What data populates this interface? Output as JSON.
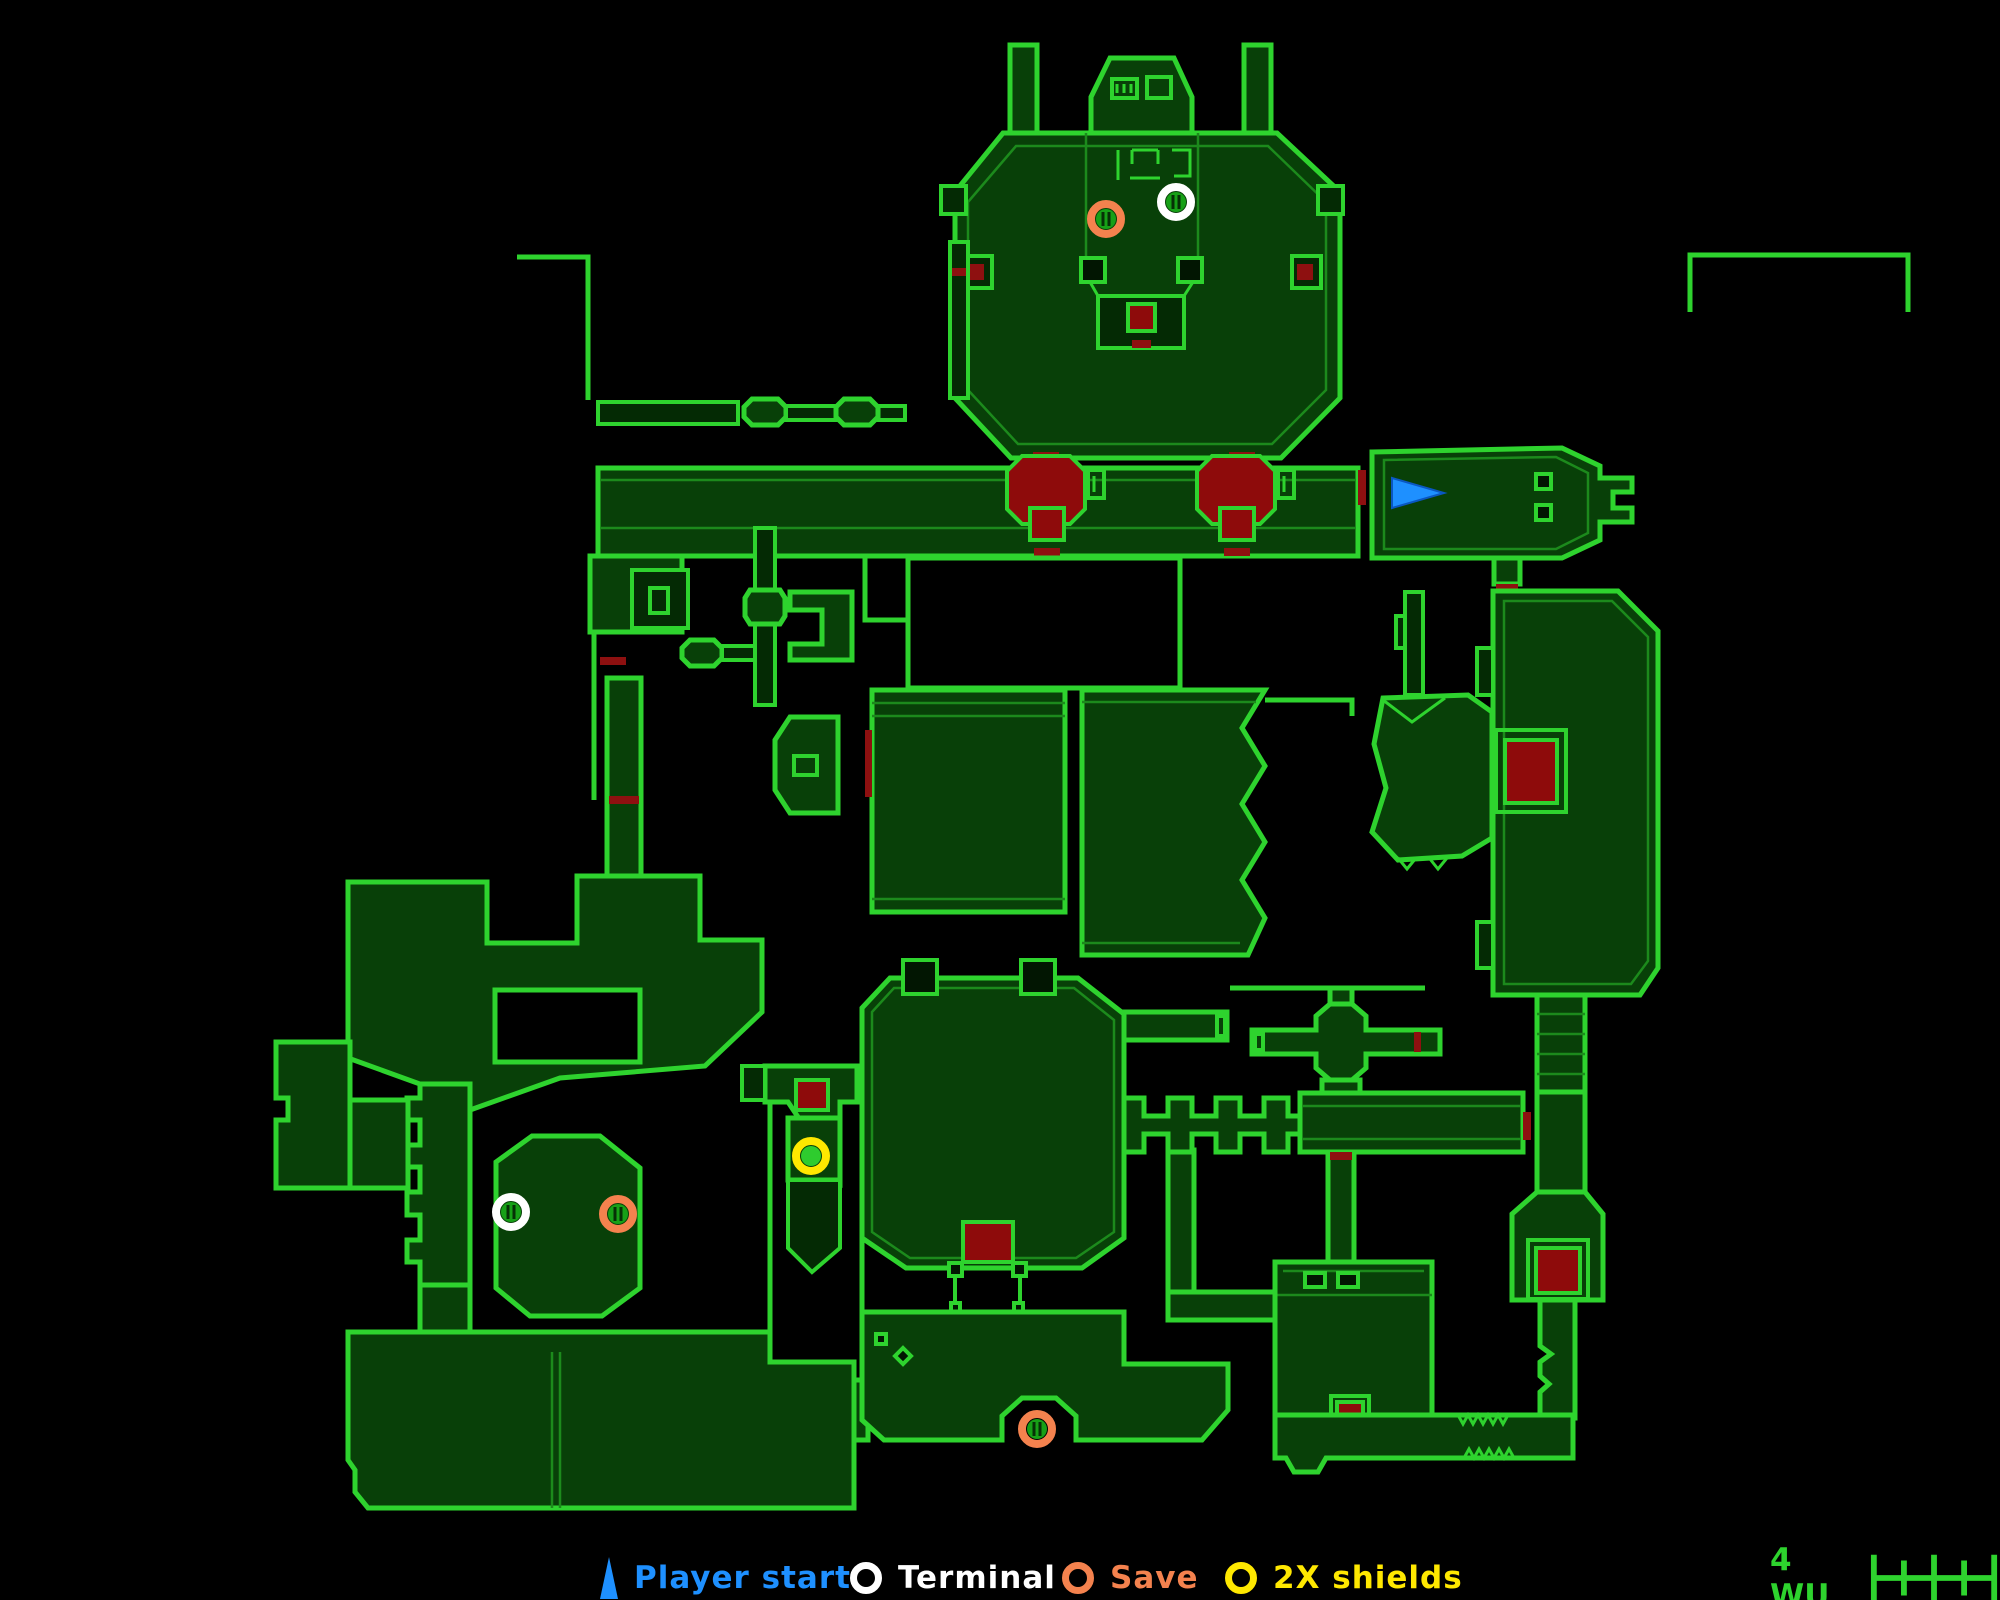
{
  "palette": {
    "background": "#000000",
    "wall": "#2ED32E",
    "innerline": "#1C8A1C",
    "room": "#084008",
    "room2": "#042a04",
    "hazard": "#8E0B0B",
    "door": "#8E1010",
    "marker_inner": "#17A017",
    "marker_slit": "#063006",
    "player_start": "#1E90FF",
    "terminal": "#FFFFFF",
    "save": "#F4824E",
    "shields": "#FFE800",
    "scale_text": "#2ED32E"
  },
  "legend": {
    "items": [
      {
        "id": "player-start",
        "label": "Player start",
        "color": "#1E90FF",
        "icon": "triangle"
      },
      {
        "id": "terminal",
        "label": "Terminal",
        "color": "#FFFFFF",
        "icon": "ring"
      },
      {
        "id": "save",
        "label": "Save",
        "color": "#F4824E",
        "icon": "ring"
      },
      {
        "id": "shields",
        "label": "2X shields",
        "color": "#FFE800",
        "icon": "ring"
      }
    ]
  },
  "scale": {
    "label": "4 WU"
  },
  "markers": [
    {
      "type": "save",
      "x": 1106,
      "y": 219
    },
    {
      "type": "terminal",
      "x": 1176,
      "y": 202
    },
    {
      "type": "player-start",
      "x": 1412,
      "y": 493
    },
    {
      "type": "terminal",
      "x": 511,
      "y": 1212
    },
    {
      "type": "save",
      "x": 618,
      "y": 1214
    },
    {
      "type": "shields",
      "x": 811,
      "y": 1156
    },
    {
      "type": "save",
      "x": 1037,
      "y": 1429
    }
  ],
  "map": {
    "shapes": [
      {
        "k": "room",
        "name": "left-chimney",
        "d": "M1010,45 L1037,45 L1037,133 L1010,133 Z"
      },
      {
        "k": "room",
        "name": "right-chimney",
        "d": "M1244,45 L1271,45 L1271,133 L1244,133 Z"
      },
      {
        "k": "room",
        "name": "top-tower",
        "d": "M1091,133 L1091,97 L1110,58 L1174,58 L1192,97 L1192,133 Z"
      },
      {
        "k": "room",
        "name": "top-chamber",
        "d": "M1003,133 L1277,133 L1340,192 L1340,398 L1281,458 L1011,458 L955,398 L955,192 Z"
      },
      {
        "k": "thin",
        "d": "M1016,146 L1268,146 L1326,202 L1326,390 L1272,444 L1018,444 L968,390 L968,202 Z"
      },
      {
        "k": "frame",
        "d": "M1112,79 L1137,79 L1137,98 L1112,98 Z"
      },
      {
        "k": "line3",
        "d": "M1117,84 L1117,93 M1124,84 L1124,93 M1131,84 L1131,93"
      },
      {
        "k": "frame",
        "d": "M1147,77 L1171,77 L1171,98 L1147,98 Z"
      },
      {
        "k": "thin",
        "d": "M1086,133 L1086,260 M1198,133 L1198,260"
      },
      {
        "k": "line3",
        "d": "M1118,150 L1118,180 M1132,150 L1132,164 M1132,150 L1158,150 M1158,150 L1158,164 M1172,150 L1190,150 L1190,176 L1174,176 M1130,178 L1160,178"
      },
      {
        "k": "outline",
        "d": "M941,186 L966,186 L966,214 L941,214 Z"
      },
      {
        "k": "outline",
        "d": "M1318,186 L1343,186 L1343,214 L1318,214 Z"
      },
      {
        "k": "outline",
        "d": "M963,256 L992,256 L992,288 L963,288 Z"
      },
      {
        "k": "door",
        "d": "M968,264 L984,264 L984,280 L968,280 Z"
      },
      {
        "k": "outline",
        "d": "M1292,256 L1321,256 L1321,288 L1292,288 Z"
      },
      {
        "k": "door",
        "d": "M1297,264 L1313,264 L1313,280 L1297,280 Z"
      },
      {
        "k": "post",
        "d": "M1081,258 L1105,258 L1105,282 L1081,282 Z M1178,258 L1202,258 L1202,282 L1178,282 Z"
      },
      {
        "k": "outline",
        "name": "chamber-funnel",
        "d": "M1098,296 L1184,296 L1184,348 L1098,348 Z"
      },
      {
        "k": "line3",
        "d": "M1090,282 L1098,296 M1193,282 L1184,296"
      },
      {
        "k": "hazard",
        "d": "M1128,304 L1155,304 L1155,331 L1128,331 Z"
      },
      {
        "k": "door",
        "d": "M1132,340 L1151,340 L1151,348 L1132,348 Z"
      },
      {
        "k": "door",
        "d": "M1033,452 L1059,452 L1059,460 L1033,460 Z M1229,452 L1255,452 L1255,460 L1229,460 Z"
      },
      {
        "k": "line",
        "name": "northwest-wall-line",
        "d": "M517,257 L588,257 L588,400"
      },
      {
        "k": "line",
        "name": "northeast-wall-line",
        "d": "M1690,312 L1690,255 L1908,255 L1908,312"
      },
      {
        "k": "outline",
        "d": "M598,402 L738,402 L738,424 L598,424 Z"
      },
      {
        "k": "room",
        "d": "M752,399 L778,399 L786,407 L786,417 L778,425 L752,425 L744,417 L744,407 Z"
      },
      {
        "k": "outline",
        "d": "M786,406 L836,406 L836,420 L786,420 Z M878,406 L905,406 L905,420 L878,420 Z"
      },
      {
        "k": "room",
        "d": "M844,399 L870,399 L878,407 L878,417 L870,425 L844,425 L836,417 L836,407 Z"
      },
      {
        "k": "outline",
        "d": "M950,242 L968,242 L968,398 L950,398 Z"
      },
      {
        "k": "door",
        "d": "M952,268 L966,268 L966,276 L952,276 Z"
      },
      {
        "k": "room",
        "name": "main-corridor",
        "d": "M598,468 L1358,468 L1358,556 L598,556 Z"
      },
      {
        "k": "thin",
        "d": "M600,480 L1356,480 M600,528 L1356,528"
      },
      {
        "k": "hazard",
        "name": "lava-pillar-west",
        "d": "M1022,456 L1070,456 L1085,471 L1085,509 L1070,524 L1022,524 L1007,509 L1007,471 Z"
      },
      {
        "k": "hazard",
        "name": "lava-pillar-east",
        "d": "M1212,456 L1260,456 L1275,471 L1275,509 L1260,524 L1212,524 L1197,509 L1197,471 Z"
      },
      {
        "k": "frame",
        "d": "M1088,470 L1104,470 L1104,498 L1088,498 Z M1278,470 L1294,470 L1294,498 L1278,498 Z"
      },
      {
        "k": "line3",
        "d": "M1094,476 L1094,492 M1284,476 L1284,492"
      },
      {
        "k": "hazard",
        "d": "M1030,508 L1064,508 L1064,540 L1030,540 Z M1220,508 L1254,508 L1254,540 L1220,540 Z"
      },
      {
        "k": "door",
        "d": "M1034,548 L1060,548 L1060,556 L1034,556 Z M1224,548 L1250,548 L1250,556 L1224,556 Z"
      },
      {
        "k": "door",
        "d": "M1358,470 L1366,470 L1366,505 L1358,505 Z"
      },
      {
        "k": "room",
        "name": "player-start-room",
        "d": "M1372,452 L1562,448 L1600,466 L1600,478 L1632,478 L1632,492 L1613,492 L1613,508 L1632,508 L1632,522 L1600,522 L1600,540 L1562,558 L1372,558 Z"
      },
      {
        "k": "thin",
        "d": "M1384,460 L1556,457 L1588,473 L1588,533 L1556,549 L1384,549 Z"
      },
      {
        "k": "post",
        "d": "M1536,474 L1551,474 L1551,489 L1536,489 Z M1536,505 L1551,505 L1551,520 L1536,520 Z"
      },
      {
        "k": "room",
        "d": "M1494,558 L1520,558 L1520,584 L1494,584 Z"
      },
      {
        "k": "door",
        "d": "M1496,584 L1518,584 L1518,591 L1496,591 Z"
      },
      {
        "k": "room",
        "name": "east-hall",
        "d": "M1493,591 L1618,591 L1658,631 L1658,968 L1640,995 L1493,995 Z"
      },
      {
        "k": "thin",
        "d": "M1504,601 L1612,601 L1648,637 L1648,961 L1631,984 L1504,984 Z"
      },
      {
        "k": "outline",
        "d": "M1477,648 L1493,648 L1493,695 L1477,695 Z M1477,922 L1493,922 L1493,968 L1477,968 Z"
      },
      {
        "k": "frame",
        "d": "M1496,730 L1566,730 L1566,812 L1496,812 Z"
      },
      {
        "k": "hazard",
        "name": "lava-pool-east",
        "d": "M1505,740 L1557,740 L1557,803 L1505,803 Z"
      },
      {
        "k": "room",
        "name": "ladder-shaft",
        "d": "M1537,995 L1585,995 L1585,1092 L1537,1092 Z"
      },
      {
        "k": "thin",
        "d": "M1537,1014 L1585,1014 M1537,1034 L1585,1034 M1537,1054 L1585,1054 M1537,1074 L1585,1074"
      },
      {
        "k": "room",
        "d": "M1537,1092 L1585,1092 L1585,1192 L1537,1192 Z"
      },
      {
        "k": "room",
        "name": "southeast-red-room",
        "d": "M1537,1192 L1585,1192 L1603,1214 L1603,1300 L1512,1300 L1512,1214 Z"
      },
      {
        "k": "frame",
        "d": "M1528,1240 L1588,1240 L1588,1299 L1528,1299 Z"
      },
      {
        "k": "hazard",
        "d": "M1536,1248 L1580,1248 L1580,1293 L1536,1293 Z"
      },
      {
        "k": "room",
        "d": "M1540,1300 L1575,1300 L1575,1418 L1540,1418 L1540,1392 L1549,1384 L1540,1376 L1540,1362 L1551,1354 L1540,1346 Z"
      },
      {
        "k": "door",
        "d": "M1545,1418 L1569,1418 L1569,1426 L1545,1426 Z"
      },
      {
        "k": "room",
        "name": "south-room",
        "d": "M1275,1262 L1432,1262 L1432,1415 L1275,1415 Z"
      },
      {
        "k": "thin",
        "d": "M1275,1295 L1432,1295 M1283,1271 L1424,1271"
      },
      {
        "k": "post",
        "d": "M1305,1273 L1325,1273 L1325,1287 L1305,1287 Z M1338,1273 L1358,1273 L1358,1287 L1338,1287 Z"
      },
      {
        "k": "frame",
        "d": "M1331,1396 L1369,1396 L1369,1423 L1331,1423 Z"
      },
      {
        "k": "hazard",
        "d": "M1337,1402 L1363,1402 L1363,1417 L1337,1417 Z"
      },
      {
        "k": "room",
        "name": "south-corridor",
        "d": "M1275,1415 L1573,1415 L1573,1458 L1326,1458 L1318,1472 L1294,1472 L1286,1458 L1275,1458 Z"
      },
      {
        "k": "line3",
        "d": "M1458,1415 l5,9 l5,-9 l5,9 l5,-9 l5,9 l5,-9 l5,9 l5,-9 l5,9 l5,-9 M1464,1458 l5,-9 l5,9 l5,-9 l5,9 l5,-9 l5,9 l5,-9 l5,9 l5,-9 l5,9"
      },
      {
        "k": "room",
        "d": "M1168,1150 L1194,1150 L1194,1292 L1168,1292 Z M1168,1292 L1275,1292 L1275,1320 L1168,1320 Z"
      },
      {
        "k": "room",
        "name": "comb-corridor",
        "d": "M1124,1098 L1144,1098 L1144,1116 L1168,1116 L1168,1098 L1192,1098 L1192,1116 L1216,1116 L1216,1098 L1240,1098 L1240,1116 L1264,1116 L1264,1098 L1288,1098 L1288,1116 L1306,1116 L1306,1134 L1288,1134 L1288,1152 L1264,1152 L1264,1134 L1240,1134 L1240,1152 L1216,1152 L1216,1134 L1192,1134 L1192,1152 L1168,1152 L1168,1134 L1144,1134 L1144,1152 L1124,1152 Z"
      },
      {
        "k": "door",
        "d": "M1114,1104 L1122,1104 L1122,1146 L1114,1146 Z"
      },
      {
        "k": "room",
        "name": "cross-junction",
        "d": "M1252,1030 L1316,1030 L1316,1016 L1330,1004 L1352,1004 L1366,1016 L1366,1030 L1440,1030 L1440,1054 L1366,1054 L1366,1068 L1352,1080 L1330,1080 L1316,1068 L1316,1054 L1252,1054 Z"
      },
      {
        "k": "room",
        "d": "M1330,988 L1352,988 L1352,1004 L1330,1004 Z M1322,1080 L1360,1080 L1360,1093 L1322,1093 Z"
      },
      {
        "k": "door",
        "d": "M1414,1032 L1421,1032 L1421,1052 L1414,1052 Z"
      },
      {
        "k": "frame",
        "d": "M1255,1034 L1263,1034 L1263,1050 L1255,1050 Z"
      },
      {
        "k": "line",
        "d": "M1230,988 L1425,988"
      },
      {
        "k": "room",
        "d": "M1300,1093 L1523,1093 L1523,1152 L1300,1152 Z"
      },
      {
        "k": "thin",
        "d": "M1302,1106 L1521,1106 M1302,1139 L1521,1139"
      },
      {
        "k": "door",
        "d": "M1523,1112 L1531,1112 L1531,1140 L1523,1140 Z"
      },
      {
        "k": "room",
        "d": "M1328,1152 L1354,1152 L1354,1262 L1328,1262 Z"
      },
      {
        "k": "door",
        "d": "M1330,1152 L1352,1152 L1352,1160 L1330,1160 Z"
      },
      {
        "k": "room",
        "name": "central-east-room",
        "d": "M1082,690 L1265,690 L1242,728 L1265,766 L1242,804 L1265,842 L1242,880 L1265,918 L1248,955 L1082,955 Z"
      },
      {
        "k": "thin",
        "d": "M1082,702 L1256,702 M1082,943 L1240,943"
      },
      {
        "k": "line",
        "d": "M1265,700 L1352,700 L1352,716"
      },
      {
        "k": "room",
        "name": "central-west-room",
        "d": "M872,690 L1065,690 L1065,912 L872,912 Z"
      },
      {
        "k": "thin",
        "d": "M872,703 L1065,703 M872,716 L1065,716 M872,899 L1065,899"
      },
      {
        "k": "door",
        "d": "M865,730 L872,730 L872,797 L865,797 Z"
      },
      {
        "k": "room",
        "d": "M775,740 L790,717 L838,717 L838,813 L790,813 L775,790 Z"
      },
      {
        "k": "frame",
        "d": "M794,756 L817,756 L817,775 L794,775 Z"
      },
      {
        "k": "voidb",
        "name": "pit",
        "d": "M908,558 L1180,558 L1180,688 L908,688 Z"
      },
      {
        "k": "line",
        "d": "M908,620 L865,620 L865,558"
      },
      {
        "k": "room",
        "d": "M1383,698 L1468,695 L1492,712 L1492,838 L1462,856 L1398,860 L1372,832 L1386,788 L1374,744 Z"
      },
      {
        "k": "line3",
        "d": "M1398,858 L1407,869 L1416,858 M1430,859 L1438,869 L1447,858 M1383,700 L1412,722 L1445,698"
      },
      {
        "k": "outline",
        "d": "M1405,592 L1423,592 L1423,695 L1405,695 Z M1396,616 L1405,616 L1405,648 L1396,648 Z"
      },
      {
        "k": "room",
        "d": "M590,556 L682,556 L682,632 L590,632 Z"
      },
      {
        "k": "room2",
        "d": "M632,570 L688,570 L688,628 L632,628 Z"
      },
      {
        "k": "frame",
        "d": "M650,588 L668,588 L668,613 L650,613 Z"
      },
      {
        "k": "room",
        "d": "M690,640 L714,640 L722,648 L722,658 L714,666 L690,666 L682,658 L682,648 Z"
      },
      {
        "k": "outline",
        "d": "M722,646 L756,646 L756,660 L722,660 Z"
      },
      {
        "k": "outline",
        "d": "M755,528 L775,528 L775,705 L755,705 Z"
      },
      {
        "k": "room",
        "d": "M750,590 L780,590 L785,598 L785,616 L780,624 L750,624 L745,616 L745,598 Z"
      },
      {
        "k": "room",
        "d": "M790,592 L852,592 L852,660 L790,660 L790,644 L822,644 L822,610 L790,610 Z"
      },
      {
        "k": "door",
        "d": "M600,657 L626,657 L626,665 L600,665 Z"
      },
      {
        "k": "line",
        "d": "M594,632 L594,800"
      },
      {
        "k": "room",
        "d": "M607,678 L641,678 L641,878 L607,878 Z"
      },
      {
        "k": "door",
        "d": "M609,796 L639,796 L639,804 L609,804 Z"
      },
      {
        "k": "room",
        "name": "southwest-upper",
        "d": "M348,882 L487,882 L487,943 L577,943 L577,876 L700,876 L700,940 L762,940 L762,1012 L705,1066 L560,1078 L470,1110 L420,1084 L348,1058 Z"
      },
      {
        "k": "voidb",
        "d": "M495,990 L640,990 L640,1062 L495,1062 Z"
      },
      {
        "k": "room",
        "d": "M420,1084 L470,1084 L470,1285 L420,1285 L420,1262 L407,1262 L407,1240 L420,1240 L420,1215 L407,1215 L407,1192 L420,1192 L420,1167 L407,1167 L407,1145 L420,1145 L420,1120 L407,1120 L407,1098 L420,1098 Z"
      },
      {
        "k": "room",
        "d": "M276,1042 L350,1042 L350,1188 L276,1188 L276,1120 L288,1120 L288,1098 L276,1098 Z"
      },
      {
        "k": "room",
        "d": "M350,1100 L408,1100 L408,1188 L350,1188 Z"
      },
      {
        "k": "room",
        "name": "island-room",
        "d": "M496,1162 L532,1136 L600,1136 L640,1168 L640,1288 L602,1316 L530,1316 L496,1288 Z"
      },
      {
        "k": "room",
        "name": "southwest-lower",
        "d": "M348,1332 L770,1332 L770,1362 L854,1362 L854,1508 L368,1508 L355,1492 L355,1470 L348,1460 Z"
      },
      {
        "k": "room",
        "d": "M420,1285 L470,1285 L470,1332 L420,1332 Z"
      },
      {
        "k": "thin",
        "d": "M552,1352 L552,1508 M560,1352 L560,1508"
      },
      {
        "k": "room",
        "d": "M854,1380 L868,1380 L868,1440 L854,1440 Z"
      },
      {
        "k": "line",
        "d": "M770,1078 L770,1332"
      },
      {
        "k": "room",
        "d": "M765,1066 L857,1066 L857,1102 L840,1102 L840,1180 L788,1102 L788,1102 L765,1102 Z"
      },
      {
        "k": "outline",
        "d": "M742,1066 L765,1066 L765,1100 L742,1100 Z"
      },
      {
        "k": "hazard",
        "d": "M796,1080 L828,1080 L828,1110 L796,1110 Z"
      },
      {
        "k": "room",
        "name": "shields-room",
        "d": "M788,1118 L840,1118 L840,1180 L788,1180 Z"
      },
      {
        "k": "outline",
        "d": "M788,1180 L840,1180 L840,1248 L812,1272 L788,1248 Z"
      },
      {
        "k": "line",
        "d": "M862,1066 L862,1330"
      },
      {
        "k": "room",
        "name": "save-room",
        "d": "M862,1008 L890,978 L1078,978 L1124,1014 L1124,1238 L1082,1268 L906,1268 L862,1238 Z"
      },
      {
        "k": "thin",
        "d": "M872,1012 L894,988 L1074,988 L1114,1020 L1114,1232 L1076,1258 L910,1258 L872,1232 Z"
      },
      {
        "k": "post",
        "d": "M903,960 L937,960 L937,994 L903,994 Z M1021,960 L1055,960 L1055,994 L1021,994 Z"
      },
      {
        "k": "hazard",
        "d": "M963,1222 L1013,1222 L1013,1262 L963,1262 Z"
      },
      {
        "k": "frame",
        "d": "M955,1268 L1020,1268 L1020,1312 L955,1312 Z"
      },
      {
        "k": "post",
        "d": "M949,1263 L962,1263 L962,1276 L949,1276 Z M1013,1263 L1026,1263 L1026,1276 L1013,1276 Z M951,1303 L960,1303 L960,1312 L951,1312 Z M1014,1303 L1023,1303 L1023,1312 L1014,1312 Z"
      },
      {
        "k": "room",
        "d": "M862,1312 L1124,1312 L1124,1364 L1228,1364 L1228,1410 L1202,1440 L1076,1440 L1076,1416 L1056,1398 L1022,1398 L1002,1416 L1002,1440 L884,1440 L862,1420 Z"
      },
      {
        "k": "post",
        "d": "M876,1334 L886,1334 L886,1344 L876,1344 Z M903,1348 L911,1356 L903,1364 L895,1356 Z"
      },
      {
        "k": "room",
        "d": "M1124,1012 L1227,1012 L1227,1040 L1124,1040 Z"
      },
      {
        "k": "frame",
        "d": "M1217,1016 L1225,1016 L1225,1036 L1217,1036 Z"
      }
    ]
  }
}
